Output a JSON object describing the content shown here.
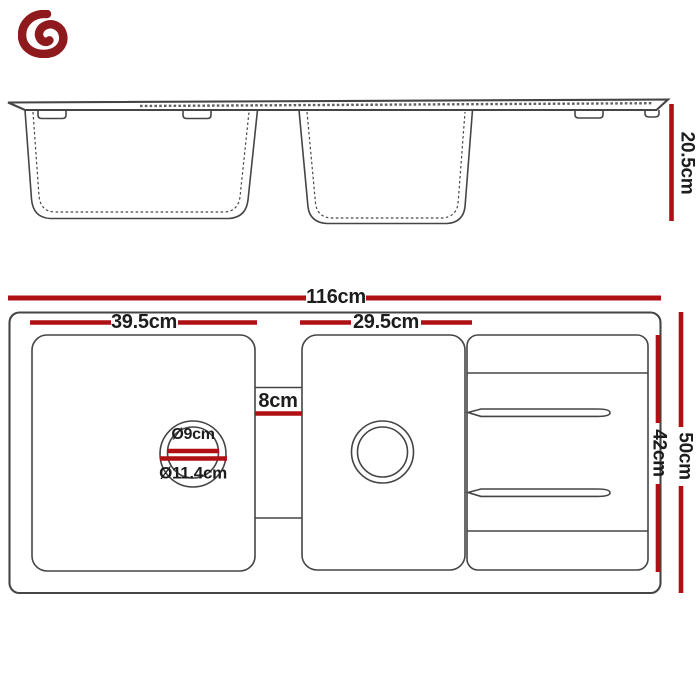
{
  "colors": {
    "dimension_red": "#B00F14",
    "drawing_line": "#454545",
    "label_ink": "#1D1D1D",
    "logo_maroon": "#8F1A1E"
  },
  "logo": {
    "icon": "brand-swirl-mark"
  },
  "side_view": {
    "overall_depth": "20.5cm"
  },
  "top_view": {
    "overall_width": "116cm",
    "left_bowl_width": "39.5cm",
    "right_bowl_width": "29.5cm",
    "divider_width": "8cm",
    "drain_hole_diameter": "Ø9cm",
    "drain_flange_diameter": "Ø11.4cm",
    "inner_depth": "42cm",
    "overall_depth": "50cm"
  }
}
